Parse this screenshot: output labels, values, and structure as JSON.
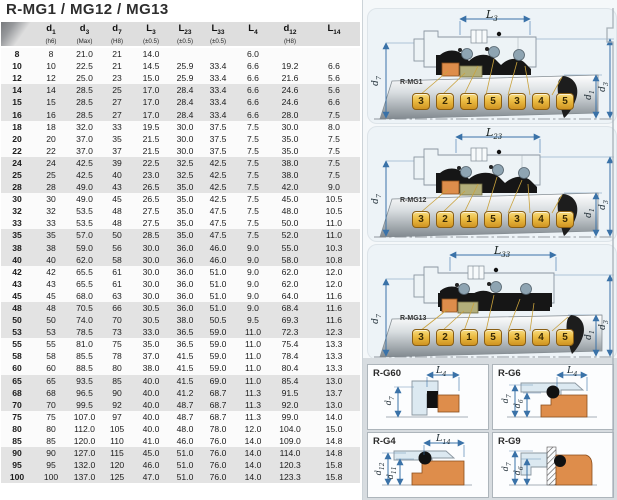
{
  "title": "R-MG1 / MG12 / MG13",
  "table": {
    "columns": [
      {
        "base": "",
        "sub": "",
        "note": "",
        "corner": true
      },
      {
        "base": "d",
        "sub": "1",
        "note": "(h6)"
      },
      {
        "base": "d",
        "sub": "3",
        "note": "(Max)"
      },
      {
        "base": "d",
        "sub": "7",
        "note": "(H8)"
      },
      {
        "base": "L",
        "sub": "3",
        "note": "(±0.5)"
      },
      {
        "base": "L",
        "sub": "23",
        "note": "(±0.5)"
      },
      {
        "base": "L",
        "sub": "33",
        "note": "(±0.5)"
      },
      {
        "base": "L",
        "sub": "4",
        "note": ""
      },
      {
        "base": "d",
        "sub": "12",
        "note": "(H8)"
      },
      {
        "base": "L",
        "sub": "14",
        "note": ""
      }
    ],
    "rows": [
      {
        "shaded": false,
        "cells": [
          "8",
          "8",
          "21.0",
          "21",
          "14.0",
          "",
          "",
          "6.0",
          "",
          ""
        ]
      },
      {
        "shaded": false,
        "cells": [
          "10",
          "10",
          "22.5",
          "21",
          "14.5",
          "25.9",
          "33.4",
          "6.6",
          "19.2",
          "6.6"
        ]
      },
      {
        "shaded": false,
        "cells": [
          "12",
          "12",
          "25.0",
          "23",
          "15.0",
          "25.9",
          "33.4",
          "6.6",
          "21.6",
          "5.6"
        ]
      },
      {
        "shaded": true,
        "cells": [
          "14",
          "14",
          "28.5",
          "25",
          "17.0",
          "28.4",
          "33.4",
          "6.6",
          "24.6",
          "5.6"
        ]
      },
      {
        "shaded": true,
        "cells": [
          "15",
          "15",
          "28.5",
          "27",
          "17.0",
          "28.4",
          "33.4",
          "6.6",
          "24.6",
          "6.6"
        ]
      },
      {
        "shaded": true,
        "cells": [
          "16",
          "16",
          "28.5",
          "27",
          "17.0",
          "28.4",
          "33.4",
          "6.6",
          "28.0",
          "7.5"
        ]
      },
      {
        "shaded": false,
        "cells": [
          "18",
          "18",
          "32.0",
          "33",
          "19.5",
          "30.0",
          "37.5",
          "7.5",
          "30.0",
          "8.0"
        ]
      },
      {
        "shaded": false,
        "cells": [
          "20",
          "20",
          "37.0",
          "35",
          "21.5",
          "30.0",
          "37.5",
          "7.5",
          "35.0",
          "7.5"
        ]
      },
      {
        "shaded": false,
        "cells": [
          "22",
          "22",
          "37.0",
          "37",
          "21.5",
          "30.0",
          "37.5",
          "7.5",
          "35.0",
          "7.5"
        ]
      },
      {
        "shaded": true,
        "cells": [
          "24",
          "24",
          "42.5",
          "39",
          "22.5",
          "32.5",
          "42.5",
          "7.5",
          "38.0",
          "7.5"
        ]
      },
      {
        "shaded": true,
        "cells": [
          "25",
          "25",
          "42.5",
          "40",
          "23.0",
          "32.5",
          "42.5",
          "7.5",
          "38.0",
          "7.5"
        ]
      },
      {
        "shaded": true,
        "cells": [
          "28",
          "28",
          "49.0",
          "43",
          "26.5",
          "35.0",
          "42.5",
          "7.5",
          "42.0",
          "9.0"
        ]
      },
      {
        "shaded": false,
        "cells": [
          "30",
          "30",
          "49.0",
          "45",
          "26.5",
          "35.0",
          "42.5",
          "7.5",
          "45.0",
          "10.5"
        ]
      },
      {
        "shaded": false,
        "cells": [
          "32",
          "32",
          "53.5",
          "48",
          "27.5",
          "35.0",
          "47.5",
          "7.5",
          "48.0",
          "10.5"
        ]
      },
      {
        "shaded": false,
        "cells": [
          "33",
          "33",
          "53.5",
          "48",
          "27.5",
          "35.0",
          "47.5",
          "7.5",
          "50.0",
          "11.0"
        ]
      },
      {
        "shaded": true,
        "cells": [
          "35",
          "35",
          "57.0",
          "50",
          "28.5",
          "35.0",
          "47.5",
          "7.5",
          "52.0",
          "11.0"
        ]
      },
      {
        "shaded": true,
        "cells": [
          "38",
          "38",
          "59.0",
          "56",
          "30.0",
          "36.0",
          "46.0",
          "9.0",
          "55.0",
          "10.3"
        ]
      },
      {
        "shaded": true,
        "cells": [
          "40",
          "40",
          "62.0",
          "58",
          "30.0",
          "36.0",
          "46.0",
          "9.0",
          "58.0",
          "10.8"
        ]
      },
      {
        "shaded": false,
        "cells": [
          "42",
          "42",
          "65.5",
          "61",
          "30.0",
          "36.0",
          "51.0",
          "9.0",
          "62.0",
          "12.0"
        ]
      },
      {
        "shaded": false,
        "cells": [
          "43",
          "43",
          "65.5",
          "61",
          "30.0",
          "36.0",
          "51.0",
          "9.0",
          "62.0",
          "12.0"
        ]
      },
      {
        "shaded": false,
        "cells": [
          "45",
          "45",
          "68.0",
          "63",
          "30.0",
          "36.0",
          "51.0",
          "9.0",
          "64.0",
          "11.6"
        ]
      },
      {
        "shaded": true,
        "cells": [
          "48",
          "48",
          "70.5",
          "66",
          "30.5",
          "36.0",
          "51.0",
          "9.0",
          "68.4",
          "11.6"
        ]
      },
      {
        "shaded": true,
        "cells": [
          "50",
          "50",
          "74.0",
          "70",
          "30.5",
          "38.0",
          "50.5",
          "9.5",
          "69.3",
          "11.6"
        ]
      },
      {
        "shaded": true,
        "cells": [
          "53",
          "53",
          "78.5",
          "73",
          "33.0",
          "36.5",
          "59.0",
          "11.0",
          "72.3",
          "12.3"
        ]
      },
      {
        "shaded": false,
        "cells": [
          "55",
          "55",
          "81.0",
          "75",
          "35.0",
          "36.5",
          "59.0",
          "11.0",
          "75.4",
          "13.3"
        ]
      },
      {
        "shaded": false,
        "cells": [
          "58",
          "58",
          "85.5",
          "78",
          "37.0",
          "41.5",
          "59.0",
          "11.0",
          "78.4",
          "13.3"
        ]
      },
      {
        "shaded": false,
        "cells": [
          "60",
          "60",
          "88.5",
          "80",
          "38.0",
          "41.5",
          "59.0",
          "11.0",
          "80.4",
          "13.3"
        ]
      },
      {
        "shaded": true,
        "cells": [
          "65",
          "65",
          "93.5",
          "85",
          "40.0",
          "41.5",
          "69.0",
          "11.0",
          "85.4",
          "13.0"
        ]
      },
      {
        "shaded": true,
        "cells": [
          "68",
          "68",
          "96.5",
          "90",
          "40.0",
          "41.2",
          "68.7",
          "11.3",
          "91.5",
          "13.7"
        ]
      },
      {
        "shaded": true,
        "cells": [
          "70",
          "70",
          "99.5",
          "92",
          "40.0",
          "48.7",
          "68.7",
          "11.3",
          "92.0",
          "13.0"
        ]
      },
      {
        "shaded": false,
        "cells": [
          "75",
          "75",
          "107.0",
          "97",
          "40.0",
          "48.7",
          "68.7",
          "11.3",
          "99.0",
          "14.0"
        ]
      },
      {
        "shaded": false,
        "cells": [
          "80",
          "80",
          "112.0",
          "105",
          "40.0",
          "48.0",
          "78.0",
          "12.0",
          "104.0",
          "15.0"
        ]
      },
      {
        "shaded": false,
        "cells": [
          "85",
          "85",
          "120.0",
          "110",
          "41.0",
          "46.0",
          "76.0",
          "14.0",
          "109.0",
          "14.8"
        ]
      },
      {
        "shaded": true,
        "cells": [
          "90",
          "90",
          "127.0",
          "115",
          "45.0",
          "51.0",
          "76.0",
          "14.0",
          "114.0",
          "14.8"
        ]
      },
      {
        "shaded": true,
        "cells": [
          "95",
          "95",
          "132.0",
          "120",
          "46.0",
          "51.0",
          "76.0",
          "14.0",
          "120.3",
          "15.8"
        ]
      },
      {
        "shaded": true,
        "cells": [
          "100",
          "100",
          "137.0",
          "125",
          "47.0",
          "51.0",
          "76.0",
          "14.0",
          "123.3",
          "15.8"
        ]
      }
    ]
  },
  "diagrams": [
    {
      "label": "R-MG1",
      "dim": {
        "base": "L",
        "sub": "3"
      },
      "badges": [
        "3",
        "2",
        "1",
        "5",
        "3",
        "4",
        "5"
      ],
      "dim_left": {
        "base": "d",
        "sub": "7"
      },
      "dims_right": [
        {
          "base": "d",
          "sub": "1"
        },
        {
          "base": "d",
          "sub": "3"
        }
      ]
    },
    {
      "label": "R-MG12",
      "dim": {
        "base": "L",
        "sub": "23"
      },
      "badges": [
        "3",
        "2",
        "1",
        "5",
        "3",
        "4",
        "5"
      ],
      "dim_left": {
        "base": "d",
        "sub": "7"
      },
      "dims_right": [
        {
          "base": "d",
          "sub": "1"
        },
        {
          "base": "d",
          "sub": "3"
        }
      ]
    },
    {
      "label": "R-MG13",
      "dim": {
        "base": "L",
        "sub": "33"
      },
      "badges": [
        "3",
        "2",
        "1",
        "5",
        "3",
        "4",
        "5"
      ],
      "dim_left": {
        "base": "d",
        "sub": "7"
      },
      "dims_right": [
        {
          "base": "d",
          "sub": "1"
        },
        {
          "base": "d",
          "sub": "3"
        }
      ]
    }
  ],
  "panels": [
    {
      "label": "R-G60",
      "dim": {
        "base": "L",
        "sub": "4"
      },
      "vdims": [
        {
          "base": "d",
          "sub": "7"
        }
      ]
    },
    {
      "label": "R-G6",
      "dim": {
        "base": "L",
        "sub": "4"
      },
      "vdims": [
        {
          "base": "d",
          "sub": "7"
        },
        {
          "base": "d",
          "sub": "6"
        }
      ]
    },
    {
      "label": "R-G4",
      "dim": {
        "base": "L",
        "sub": "14"
      },
      "vdims": [
        {
          "base": "d",
          "sub": "12"
        },
        {
          "base": "d",
          "sub": "11"
        }
      ]
    },
    {
      "label": "R-G9",
      "vdims": [
        {
          "base": "d",
          "sub": "7"
        },
        {
          "base": "d",
          "sub": "6"
        }
      ]
    }
  ],
  "colors": {
    "header_bg": "#dedede",
    "row_shaded": "#e3e3e3",
    "badge_gold": "#eaba40",
    "part_orange": "#de8d4b",
    "part_olive": "#b2ae7a",
    "rubber_black": "#161616",
    "dimension_blue": "#3a72a8",
    "right_background": "#edf3f7",
    "detail_background": "#d7dce0"
  }
}
